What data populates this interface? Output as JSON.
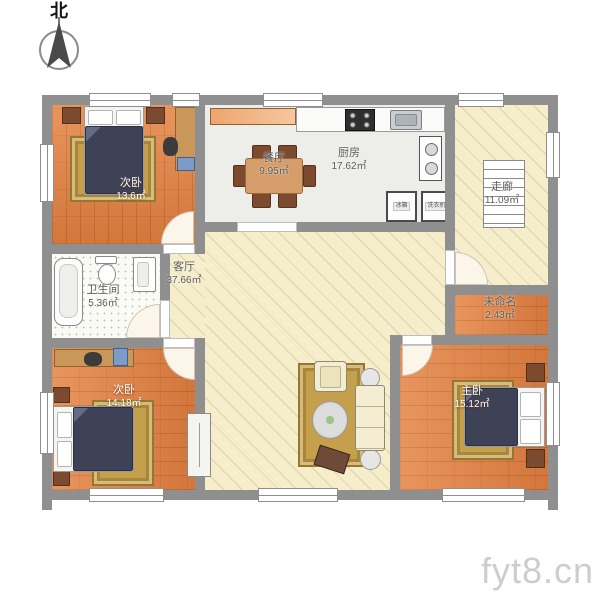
{
  "compass": {
    "north_label": "北"
  },
  "watermark": {
    "text": "fyt8.cn"
  },
  "rooms": {
    "bedroom_top_left": {
      "name": "次卧",
      "area": "13.6㎡"
    },
    "dining": {
      "name": "餐厅",
      "area": "9.95㎡"
    },
    "kitchen": {
      "name": "厨房",
      "area": "17.62㎡"
    },
    "corridor": {
      "name": "走廊",
      "area": "11.09㎡"
    },
    "bathroom": {
      "name": "卫生间",
      "area": "5.36㎡"
    },
    "living": {
      "name": "客厅",
      "area": "37.66㎡"
    },
    "unnamed": {
      "name": "未命名",
      "area": "2.43㎡"
    },
    "bedroom_bottom_left": {
      "name": "次卧",
      "area": "14.18㎡"
    },
    "master": {
      "name": "主卧",
      "area": "15.12㎡"
    }
  },
  "kitchen_appliances": {
    "fridge": "冰箱",
    "washer": "洗衣机"
  },
  "colors": {
    "wall": "#8f8f8f",
    "wood_floor": "#e08144",
    "tile_floor": "#ededea",
    "hatch_floor": "#f6eecb",
    "bathroom_floor": "#fbfbf6",
    "rug_gold": "#c5a04c",
    "bed_navy": "#3e4257",
    "furniture_tan": "#c9975a",
    "chair_brown": "#7c4a2e",
    "table_wood": "#d49d6a",
    "label_gray": "#5c5c5c",
    "label_light": "#fcfcfc",
    "watermark_gray": "#c8c8c8"
  }
}
